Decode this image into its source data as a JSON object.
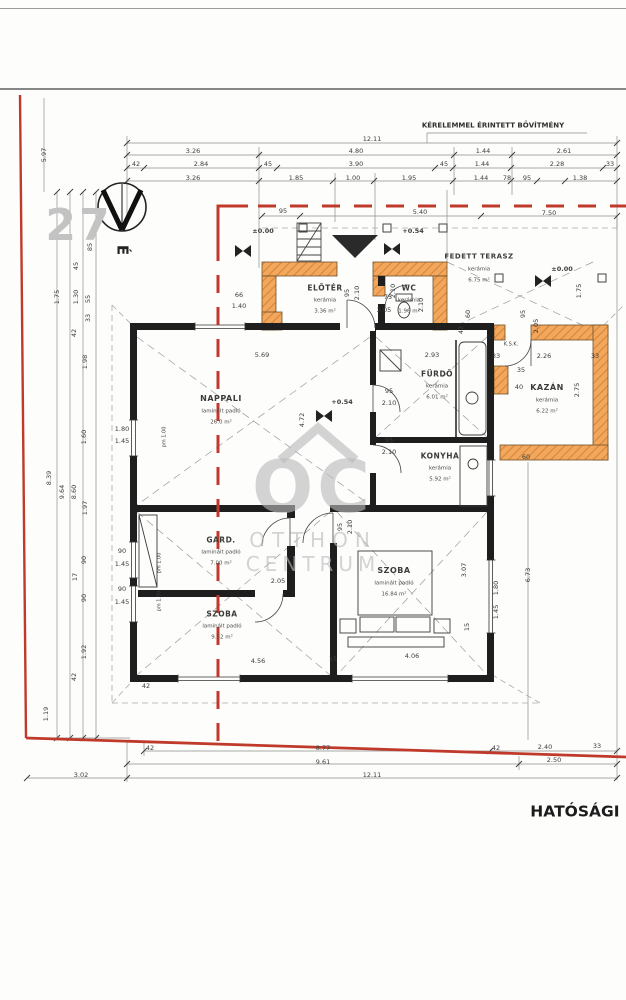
{
  "page": {
    "type": "architectural floor plan",
    "extension_note": "KÉRELEMMEL ÉRINTETT BŐVÍTMÉNY",
    "authority_text": "HATÓSÁGI BIZ",
    "parcel_number": "27",
    "north_letter": "É",
    "watermark": {
      "logo": "OC",
      "line1": "OTTHON",
      "line2": "CENTRUM"
    }
  },
  "colors": {
    "new_wall_orange": "#f3a75c",
    "new_wall_hatch": "#d4873a",
    "boundary_red": "#c03a2b",
    "wall_black": "#1e1e1e",
    "watermark_gray": "#bababa",
    "dim_gray": "#8c8c8c"
  },
  "annotations": {
    "rooms": [
      {
        "id": "nappali",
        "name": "NAPPALI",
        "floor": "laminált padló",
        "area": "26.0 m²",
        "x": 221,
        "y": 399,
        "s": 8
      },
      {
        "id": "eloter",
        "name": "ELŐTÉR",
        "floor": "kerámia",
        "area": "3.36 m²",
        "x": 325,
        "y": 288,
        "s": 7.5
      },
      {
        "id": "wc",
        "name": "WC",
        "floor": "kerámia",
        "area": "1.96 m²",
        "x": 409,
        "y": 288,
        "s": 7.5
      },
      {
        "id": "fedett-terasz",
        "name": "FEDETT TERASZ",
        "floor": "kerámia",
        "area": "6.75 m²",
        "x": 479,
        "y": 257,
        "s": 7
      },
      {
        "id": "furdo",
        "name": "FÜRDŐ",
        "floor": "kerámia",
        "area": "6.01 m²",
        "x": 437,
        "y": 374,
        "s": 7.5
      },
      {
        "id": "kazan",
        "name": "KAZÁN",
        "floor": "kerámia",
        "area": "6.22 m²",
        "x": 547,
        "y": 388,
        "s": 8
      },
      {
        "id": "konyha",
        "name": "KONYHA",
        "floor": "kerámia",
        "area": "5.92 m²",
        "x": 440,
        "y": 456,
        "s": 7.5
      },
      {
        "id": "gard",
        "name": "GARD.",
        "floor": "laminált padló",
        "area": "7.00 m²",
        "x": 221,
        "y": 540,
        "s": 7.5
      },
      {
        "id": "szoba-bal",
        "name": "SZOBA",
        "floor": "laminált padló",
        "area": "9.52 m²",
        "x": 222,
        "y": 614,
        "s": 7.5
      },
      {
        "id": "szoba-jobb",
        "name": "SZOBA",
        "floor": "laminált padló",
        "area": "16.84 m²",
        "x": 394,
        "y": 571,
        "s": 8
      }
    ],
    "texts": [
      {
        "n": "extension-note",
        "t": "KÉRELEMMEL ÉRINTETT BŐVÍTMÉNY",
        "x": 493,
        "y": 126,
        "s": 7,
        "b": 1,
        "c": "#2e2e2e"
      },
      {
        "n": "parcel-number",
        "t": "27",
        "x": 79,
        "y": 226,
        "s": 44,
        "b": 1,
        "c": "#c3c3c3",
        "ls": 3
      },
      {
        "n": "north-letter",
        "t": "É",
        "x": 122,
        "y": 250,
        "s": 15,
        "b": 1,
        "c": "#222",
        "r": 90
      },
      {
        "n": "authority-text",
        "t": "HATÓSÁGI BIZ",
        "x": 592,
        "y": 812,
        "s": 15.5,
        "b": 1,
        "c": "#1c1c1c"
      },
      {
        "n": "watermark-logo",
        "t": "OC",
        "x": 313,
        "y": 487,
        "s": 72,
        "b": 1,
        "c": "rgba(186,186,186,0.62)",
        "ls": 4
      },
      {
        "n": "watermark-line1",
        "t": "OTTHON",
        "x": 313,
        "y": 540,
        "s": 20,
        "c": "rgba(186,186,186,0.62)",
        "ls": 7
      },
      {
        "n": "watermark-line2",
        "t": "CENTRUM",
        "x": 313,
        "y": 564,
        "s": 20,
        "c": "rgba(186,186,186,0.62)",
        "ls": 5
      },
      {
        "n": "elevation-label",
        "t": "±0.00",
        "x": 263,
        "y": 231,
        "s": 6.5,
        "b": 1
      },
      {
        "n": "elevation-label",
        "t": "+0.54",
        "x": 413,
        "y": 231,
        "s": 6.5,
        "b": 1
      },
      {
        "n": "elevation-label",
        "t": "±0.00",
        "x": 562,
        "y": 269,
        "s": 6.5,
        "b": 1
      },
      {
        "n": "elevation-label",
        "t": "+0.54",
        "x": 342,
        "y": 402,
        "s": 6.5,
        "b": 1
      },
      {
        "n": "note-ksk",
        "t": "K.S.K.",
        "x": 511,
        "y": 345,
        "s": 5
      }
    ],
    "dims": [
      {
        "t": "12.11",
        "x": 372,
        "y": 139
      },
      {
        "t": "3.26",
        "x": 193,
        "y": 151
      },
      {
        "t": "4.80",
        "x": 356,
        "y": 151
      },
      {
        "t": "1.44",
        "x": 483,
        "y": 151
      },
      {
        "t": "2.61",
        "x": 564,
        "y": 151
      },
      {
        "t": "42",
        "x": 136,
        "y": 164
      },
      {
        "t": "2.84",
        "x": 201,
        "y": 164
      },
      {
        "t": "45",
        "x": 268,
        "y": 164
      },
      {
        "t": "3.90",
        "x": 356,
        "y": 164
      },
      {
        "t": "45",
        "x": 444,
        "y": 164
      },
      {
        "t": "1.44",
        "x": 482,
        "y": 164
      },
      {
        "t": "2.28",
        "x": 557,
        "y": 164
      },
      {
        "t": "33",
        "x": 610,
        "y": 164
      },
      {
        "t": "3.26",
        "x": 193,
        "y": 178
      },
      {
        "t": "1.85",
        "x": 296,
        "y": 178
      },
      {
        "t": "1.00",
        "x": 353,
        "y": 178
      },
      {
        "t": "1.95",
        "x": 409,
        "y": 178
      },
      {
        "t": "1.44",
        "x": 481,
        "y": 178
      },
      {
        "t": "78",
        "x": 507,
        "y": 178
      },
      {
        "t": "95",
        "x": 527,
        "y": 178
      },
      {
        "t": "1.38",
        "x": 580,
        "y": 178
      },
      {
        "t": "95",
        "x": 283,
        "y": 211
      },
      {
        "t": "5.40",
        "x": 420,
        "y": 212
      },
      {
        "t": "7.50",
        "x": 549,
        "y": 213
      },
      {
        "t": "5.97",
        "x": 44,
        "y": 155,
        "r": 1
      },
      {
        "t": "85",
        "x": 90,
        "y": 247,
        "r": 1
      },
      {
        "t": "45",
        "x": 76,
        "y": 266,
        "r": 1
      },
      {
        "t": "1.75",
        "x": 57,
        "y": 297,
        "r": 1
      },
      {
        "t": "1.30",
        "x": 76,
        "y": 297,
        "r": 1
      },
      {
        "t": "55",
        "x": 88,
        "y": 299,
        "r": 1
      },
      {
        "t": "33",
        "x": 88,
        "y": 318,
        "r": 1
      },
      {
        "t": "42",
        "x": 74,
        "y": 333,
        "r": 1
      },
      {
        "t": "1.98",
        "x": 85,
        "y": 362,
        "r": 1
      },
      {
        "t": "8.39",
        "x": 49,
        "y": 478,
        "r": 1
      },
      {
        "t": "9.64",
        "x": 62,
        "y": 492,
        "r": 1
      },
      {
        "t": "8.60",
        "x": 74,
        "y": 492,
        "r": 1
      },
      {
        "t": "1.60",
        "x": 84,
        "y": 437,
        "r": 1
      },
      {
        "t": "1.97",
        "x": 85,
        "y": 508,
        "r": 1
      },
      {
        "t": "90",
        "x": 84,
        "y": 560,
        "r": 1
      },
      {
        "t": "17",
        "x": 75,
        "y": 577,
        "r": 1
      },
      {
        "t": "90",
        "x": 84,
        "y": 598,
        "r": 1
      },
      {
        "t": "1.92",
        "x": 84,
        "y": 652,
        "r": 1
      },
      {
        "t": "42",
        "x": 74,
        "y": 677,
        "r": 1
      },
      {
        "t": "1.19",
        "x": 46,
        "y": 714,
        "r": 1
      },
      {
        "t": "1.80",
        "x": 122,
        "y": 429
      },
      {
        "t": "1.45",
        "x": 122,
        "y": 441
      },
      {
        "t": "90",
        "x": 122,
        "y": 551
      },
      {
        "t": "1.45",
        "x": 122,
        "y": 564
      },
      {
        "t": "90",
        "x": 122,
        "y": 589
      },
      {
        "t": "1.45",
        "x": 122,
        "y": 602
      },
      {
        "t": "pm 1.00",
        "x": 165,
        "y": 437,
        "r": 1,
        "s": 5
      },
      {
        "t": "pm 1.00",
        "x": 160,
        "y": 563,
        "r": 1,
        "s": 5
      },
      {
        "t": "pm 1.00",
        "x": 160,
        "y": 601,
        "r": 1,
        "s": 5
      },
      {
        "t": "66",
        "x": 239,
        "y": 295
      },
      {
        "t": "1.40",
        "x": 239,
        "y": 306
      },
      {
        "t": "95",
        "x": 347,
        "y": 293,
        "r": 1
      },
      {
        "t": "2.10",
        "x": 357,
        "y": 293,
        "r": 1
      },
      {
        "t": "2.10",
        "x": 393,
        "y": 291,
        "r": 1
      },
      {
        "t": "75",
        "x": 388,
        "y": 297
      },
      {
        "t": "2.05",
        "x": 384,
        "y": 310
      },
      {
        "t": "60",
        "x": 468,
        "y": 314,
        "r": 1
      },
      {
        "t": "42",
        "x": 461,
        "y": 330,
        "r": 1
      },
      {
        "t": "1.75",
        "x": 579,
        "y": 291,
        "r": 1
      },
      {
        "t": "95",
        "x": 523,
        "y": 314,
        "r": 1
      },
      {
        "t": "2.05",
        "x": 536,
        "y": 326,
        "r": 1
      },
      {
        "t": "5.69",
        "x": 262,
        "y": 355
      },
      {
        "t": "2.93",
        "x": 432,
        "y": 355
      },
      {
        "t": "33",
        "x": 496,
        "y": 356
      },
      {
        "t": "2.26",
        "x": 544,
        "y": 356
      },
      {
        "t": "33",
        "x": 595,
        "y": 356
      },
      {
        "t": "35",
        "x": 521,
        "y": 370
      },
      {
        "t": "40",
        "x": 519,
        "y": 387
      },
      {
        "t": "2.75",
        "x": 577,
        "y": 390,
        "r": 1
      },
      {
        "t": "4.72",
        "x": 302,
        "y": 420,
        "r": 1
      },
      {
        "t": "2.10",
        "x": 421,
        "y": 305,
        "r": 1
      },
      {
        "t": "95",
        "x": 389,
        "y": 391
      },
      {
        "t": "2.10",
        "x": 389,
        "y": 403
      },
      {
        "t": "95",
        "x": 389,
        "y": 440
      },
      {
        "t": "2.10",
        "x": 389,
        "y": 452
      },
      {
        "t": "60",
        "x": 526,
        "y": 457
      },
      {
        "t": "95",
        "x": 340,
        "y": 527,
        "r": 1
      },
      {
        "t": "2.10",
        "x": 350,
        "y": 527,
        "r": 1
      },
      {
        "t": "2.05",
        "x": 278,
        "y": 581
      },
      {
        "t": "3.07",
        "x": 464,
        "y": 570,
        "r": 1
      },
      {
        "t": "1.80",
        "x": 496,
        "y": 588,
        "r": 1
      },
      {
        "t": "1.45",
        "x": 496,
        "y": 612,
        "r": 1
      },
      {
        "t": "15",
        "x": 467,
        "y": 627,
        "r": 1
      },
      {
        "t": "4.56",
        "x": 258,
        "y": 661
      },
      {
        "t": "15",
        "x": 333,
        "y": 659
      },
      {
        "t": "4.06",
        "x": 412,
        "y": 656
      },
      {
        "t": "42",
        "x": 146,
        "y": 686
      },
      {
        "t": "6.73",
        "x": 528,
        "y": 575,
        "r": 1
      },
      {
        "t": "42",
        "x": 150,
        "y": 748
      },
      {
        "t": "8.77",
        "x": 323,
        "y": 748
      },
      {
        "t": "9.61",
        "x": 323,
        "y": 762
      },
      {
        "t": "42",
        "x": 496,
        "y": 748
      },
      {
        "t": "2.40",
        "x": 545,
        "y": 747
      },
      {
        "t": "33",
        "x": 597,
        "y": 746
      },
      {
        "t": "2.50",
        "x": 554,
        "y": 760
      },
      {
        "t": "3.02",
        "x": 81,
        "y": 775
      },
      {
        "t": "12.11",
        "x": 372,
        "y": 775
      }
    ]
  }
}
